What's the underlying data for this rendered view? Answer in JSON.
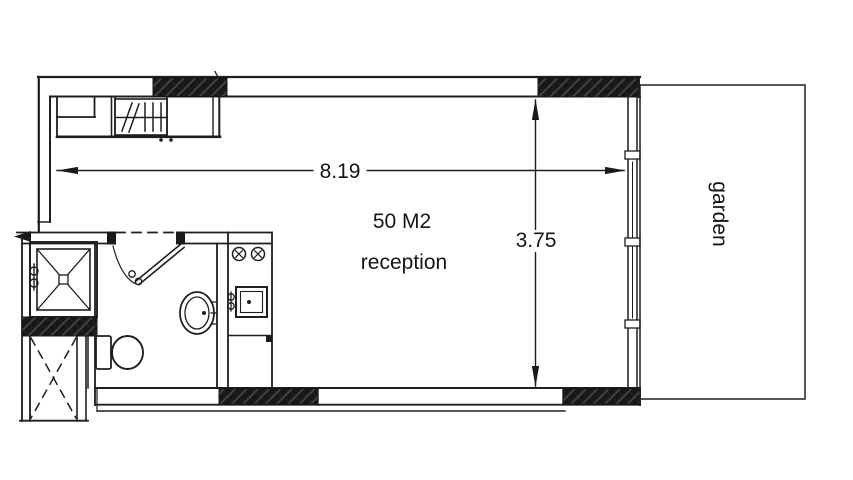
{
  "floor_plan": {
    "room": {
      "area": "50 M2",
      "name": "reception"
    },
    "dimensions": {
      "width": "8.19",
      "height": "3.75"
    },
    "garden": {
      "label": "garden"
    },
    "colors": {
      "background": "#ffffff",
      "line": "#1e1e1e",
      "wall_hatch_fill": "#171717"
    },
    "symbols": [
      "shower",
      "shower-valve",
      "toilet",
      "washbasin",
      "hinged-door",
      "duct-shaft",
      "stove-burners",
      "kitchen-sink",
      "faucet",
      "kitchen-counter",
      "sliding-glass-door",
      "entry-arrow",
      "garden-boundary"
    ]
  }
}
